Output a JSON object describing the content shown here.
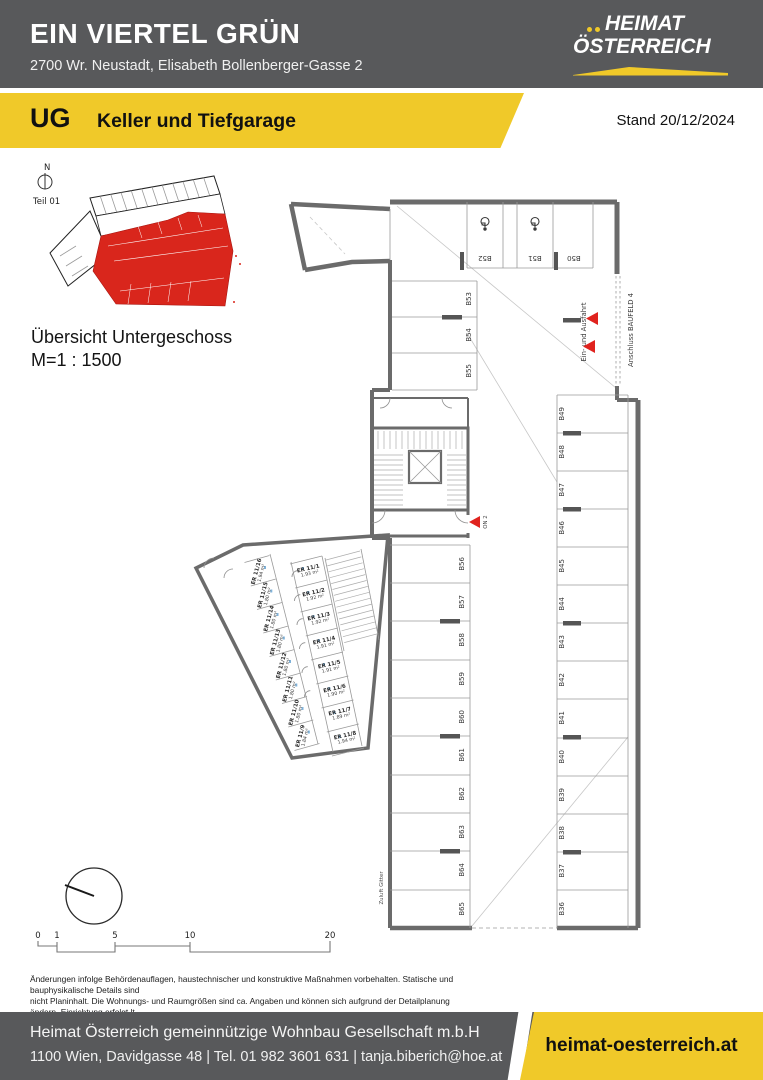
{
  "header": {
    "title": "EIN VIERTEL GRÜN",
    "address": "2700 Wr. Neustadt, Elisabeth Bollenberger-Gasse 2",
    "logo_line1": "HEIMAT",
    "logo_line2": "ÖSTERREICH"
  },
  "banner": {
    "level": "UG",
    "subtitle": "Keller und Tiefgarage",
    "date": "Stand 20/12/2024"
  },
  "overview": {
    "north_label": "N",
    "part_label": "Teil 01",
    "caption_line1": "Übersicht Untergeschoss",
    "caption_line2": "M=1 : 1500"
  },
  "plan": {
    "top_row": [
      "B52",
      "B51",
      "B50"
    ],
    "left_upper": [
      "B53",
      "B54",
      "B55"
    ],
    "left_col": [
      "B56",
      "B57",
      "B58",
      "B59",
      "B60",
      "B61",
      "B62",
      "B63",
      "B64",
      "B65"
    ],
    "right_col": [
      "B49",
      "B48",
      "B47",
      "B46",
      "B45",
      "B44",
      "B43",
      "B42",
      "B41",
      "B40",
      "B39",
      "B38",
      "B37",
      "B36"
    ],
    "storage_right": [
      {
        "name": "ER 11/1",
        "area": "1.93 m²"
      },
      {
        "name": "ER 11/2",
        "area": "1.92 m²"
      },
      {
        "name": "ER 11/3",
        "area": "1.92 m²"
      },
      {
        "name": "ER 11/4",
        "area": "1.91 m²"
      },
      {
        "name": "ER 11/5",
        "area": "1.91 m²"
      },
      {
        "name": "ER 11/6",
        "area": "1.90 m²"
      },
      {
        "name": "ER 11/7",
        "area": "1.89 m²"
      },
      {
        "name": "ER 11/8",
        "area": "1.94 m²"
      }
    ],
    "storage_left": [
      {
        "name": "ER 11/16",
        "area": "1.94 m²"
      },
      {
        "name": "ER 11/15",
        "area": "1.80 m²"
      },
      {
        "name": "ER 11/14",
        "area": "1.80 m²"
      },
      {
        "name": "ER 11/13",
        "area": "1.80 m²"
      },
      {
        "name": "ER 11/12",
        "area": "1.80 m²"
      },
      {
        "name": "ER 11/11",
        "area": "1.80 m²"
      },
      {
        "name": "ER 11/10",
        "area": "1.80 m²"
      },
      {
        "name": "ER 11/9",
        "area": "1.84 m²"
      }
    ],
    "labels": {
      "entry_exit": "Ein- und Ausfahrt",
      "baufeld": "Anschluss BAUFELD 4",
      "on2": "ON 2",
      "zuluft": "Zuluft Gitter"
    }
  },
  "scale": {
    "ticks": [
      "0",
      "1",
      "5",
      "10",
      "20"
    ]
  },
  "disclaimer": {
    "lines": [
      "Änderungen infolge Behördenauflagen, haustechnischer und konstruktive Maßnahmen vorbehalten. Statische und bauphysikalische Details sind",
      "nicht Planinhalt. Die Wohnungs- und Raumgrößen sind ca. Angaben und können sich aufgrund der Detailplanung ändern. Einrichtung erfolgt lt.",
      "Ausstattungsbeschreibung. Dieser Plan ist zum Anfertigen von Einbaumöbeln nicht geeignet. Es sind unbedingt Naturmaße zu nehmen !"
    ]
  },
  "footer": {
    "company": "Heimat Österreich gemeinnützige Wohnbau Gesellschaft m.b.H",
    "contact": "1100 Wien, Davidgasse 48 | Tel. 01 982 3601 631 | tanja.biberich@hoe.at",
    "website": "heimat-oesterreich.at"
  },
  "colors": {
    "header_gray": "#58595B",
    "accent_yellow": "#F0C929",
    "plan_red": "#E0231E",
    "overview_red": "#D9261C"
  }
}
